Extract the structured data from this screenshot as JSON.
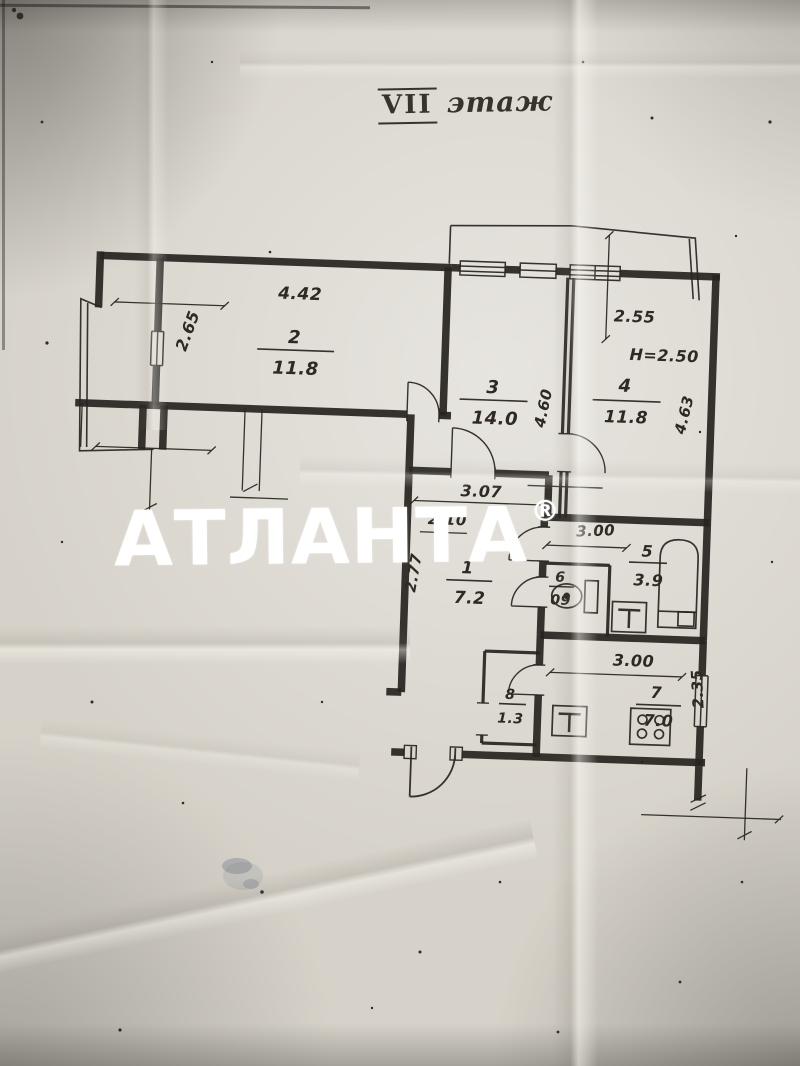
{
  "page": {
    "kind": "apartment floor plan photo"
  },
  "title": {
    "roman": "VII",
    "word": "этаж"
  },
  "watermark": {
    "text": "АТЛАНТА",
    "reg": "®",
    "color": "#ffffff"
  },
  "colors": {
    "paper": "#d6d2c9",
    "ink": "#2a2722",
    "watermark": "#ffffff"
  },
  "rooms": {
    "r1": {
      "num": "1",
      "area": "7.2"
    },
    "r2": {
      "num": "2",
      "area": "11.8"
    },
    "r3": {
      "num": "3",
      "area": "14.0"
    },
    "r4": {
      "num": "4",
      "area": "11.8"
    },
    "r5": {
      "num": "5",
      "area": "3.9"
    },
    "r6": {
      "num": "6",
      "area": "09"
    },
    "r7": {
      "num": "7",
      "area": "7.0"
    },
    "r8": {
      "num": "8",
      "area": "1.3"
    }
  },
  "dims": {
    "room2_width": "4.42",
    "room2_depth": "2.65",
    "room3_depth": "4.60",
    "room4_window": "2.55",
    "room4_depth": "4.63",
    "ceiling": "H=2.50",
    "corr_len": "3.07",
    "corr_len2": "2.10",
    "corr_depth": "2.77",
    "bath_width": "3.00",
    "kitchen_width": "3.00",
    "kitchen_window": "2.35"
  },
  "icons": {
    "fixtures": [
      "bathtub-icon",
      "toilet-icon",
      "sink-icon",
      "kitchen-sink-icon",
      "stove-icon",
      "door-swing-icon",
      "window-icon"
    ]
  }
}
